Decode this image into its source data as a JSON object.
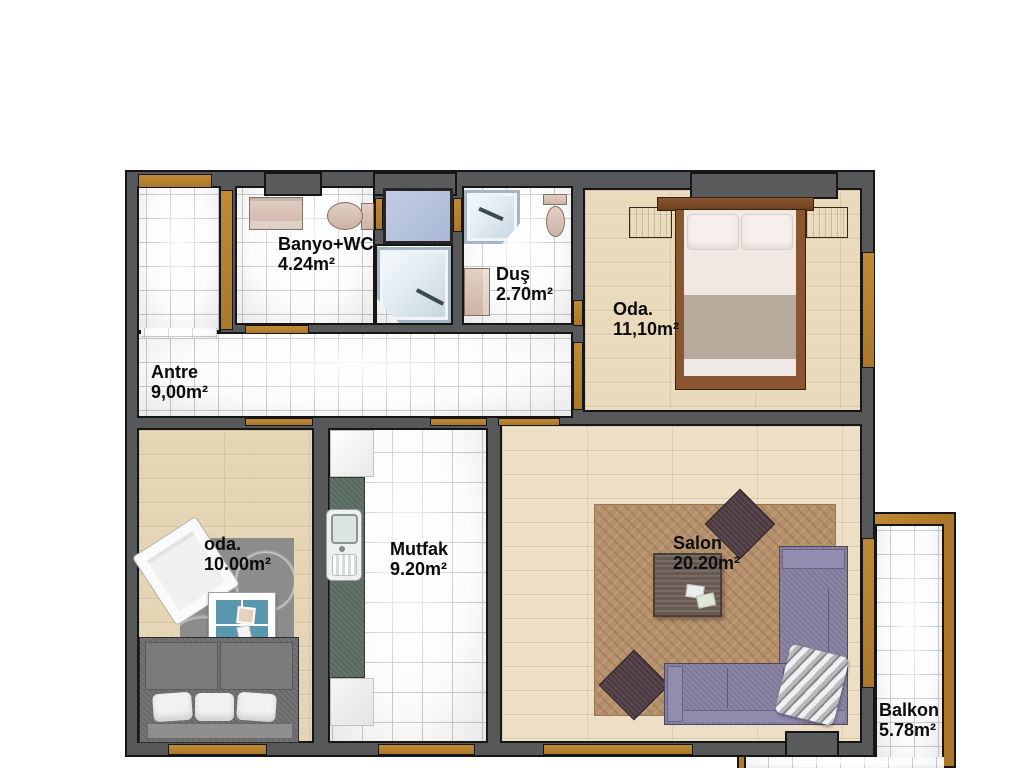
{
  "plan": {
    "type": "apartment-floor-plan",
    "language": "Turkish"
  },
  "rooms": {
    "antre": {
      "label": "Antre",
      "area": "9,00m²"
    },
    "banyo": {
      "label": "Banyo+WC",
      "area": "4.24m²"
    },
    "dus": {
      "label": "Duş",
      "area": "2.70m²"
    },
    "oda_master": {
      "label": "Oda.",
      "area": "11,10m²"
    },
    "oda_small": {
      "label": "oda.",
      "area": "10.00m²"
    },
    "mutfak": {
      "label": "Mutfak",
      "area": "9.20m²"
    },
    "salon": {
      "label": "Salon",
      "area": "20.20m²"
    },
    "balkon": {
      "label": "Balkon",
      "area": "5.78m²"
    }
  },
  "colors": {
    "wall_gray": "#57585a",
    "outline_black": "#161616",
    "window_door_wood": "#b07c2e",
    "tile_floor": "#fcfcfc",
    "wood_floor": "#e6d5b4",
    "shaft_blue": "#b7c3dd",
    "kitchen_counter_green": "#5d6e64",
    "rug_gray": "#8c8c8c",
    "rug_tan": "#b5906a",
    "sofa_gray": "#6e6e6e",
    "sofa_purple": "#857f9e",
    "table_teal": "#5897ad",
    "ottoman_maroon": "#513e46",
    "bed_wood": "#8a5631",
    "label_text": "#0c0c0c"
  }
}
